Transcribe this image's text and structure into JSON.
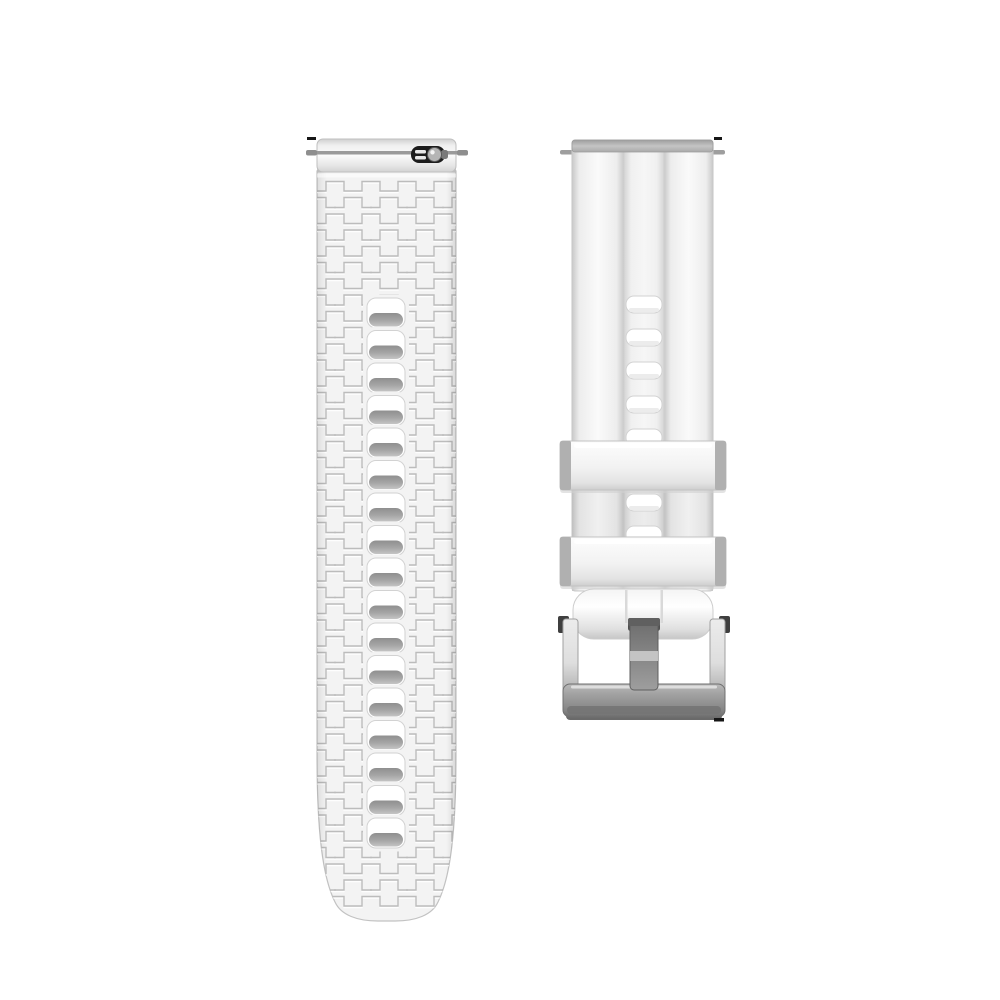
{
  "scene": {
    "description": "Product photo: white silicone quick-release watch strap shown as two separate pieces on a plain white background",
    "background_color": "#ffffff"
  },
  "colors": {
    "strap_base": "#f3f3f3",
    "strap_edge": "#c2c2c2",
    "pattern_line": "#bcbcbc",
    "pattern_highlight": "#ffffff",
    "hole_fill": "#ffffff",
    "hole_stroke": "#d2d2d2",
    "ledge_dark": "#949494",
    "spring_bar": "#9a9a9a",
    "toggle_dark": "#1c1c1c",
    "toggle_knob": "#b5b5b5",
    "top_band": "#b3b3b3",
    "keeper_cap": "#b0b0b0",
    "keeper_stroke": "#c2c2c2",
    "tongue": "#8b8b8b",
    "tongue_outline": "#5f5f5f",
    "slot": "#4f4f4f",
    "nub": "#3f3f3f",
    "bar_stroke": "#707070",
    "artifact": "#161616"
  },
  "left_strap": {
    "part": "strap-tail-piece",
    "hole_count": 17,
    "hole_start_y": 298,
    "hole_spacing": 32.5,
    "hole_width": 38,
    "hole_height": 30,
    "center_x": 386
  },
  "right_strap": {
    "part": "strap-buckle-piece",
    "hole_tops_y": [
      296,
      329,
      362,
      396,
      429,
      494,
      526
    ],
    "hole_width": 36,
    "hole_height": 17,
    "center_x": 644,
    "keeper_tops_y": [
      441,
      537
    ],
    "keeper_count": 2
  },
  "buckle": {
    "type": "pin-buckle",
    "finish": "silver"
  }
}
